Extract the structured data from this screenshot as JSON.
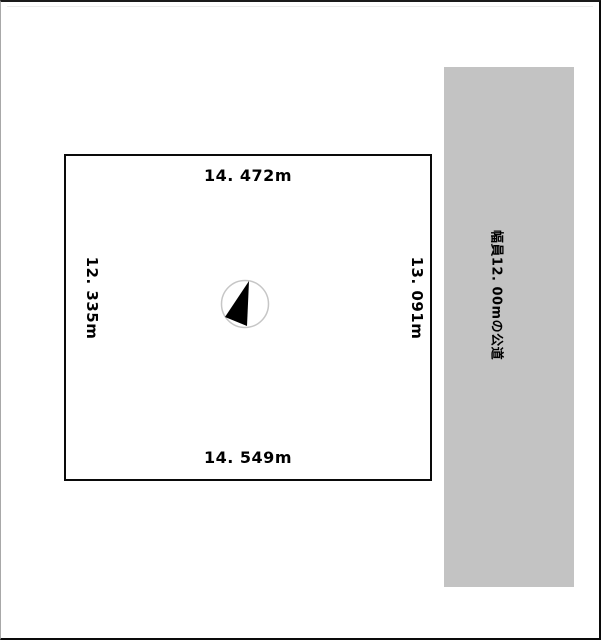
{
  "page": {
    "background": "#ffffff",
    "frame_color": "#0a0a0a"
  },
  "parcel": {
    "dimensions": {
      "top": "14. 472m",
      "bottom": "14. 549m",
      "left": "12. 335m",
      "right": "13. 091m"
    },
    "line_color": "#0a0a0a"
  },
  "road": {
    "label": "幅員12. 00mの公道",
    "fill": "#c3c3c3"
  },
  "icons": {
    "north_arrow": "north-arrow-icon"
  },
  "colors": {
    "compass_ring": "#c6c6c6",
    "compass_needle": "#000000",
    "text": "#000000"
  }
}
